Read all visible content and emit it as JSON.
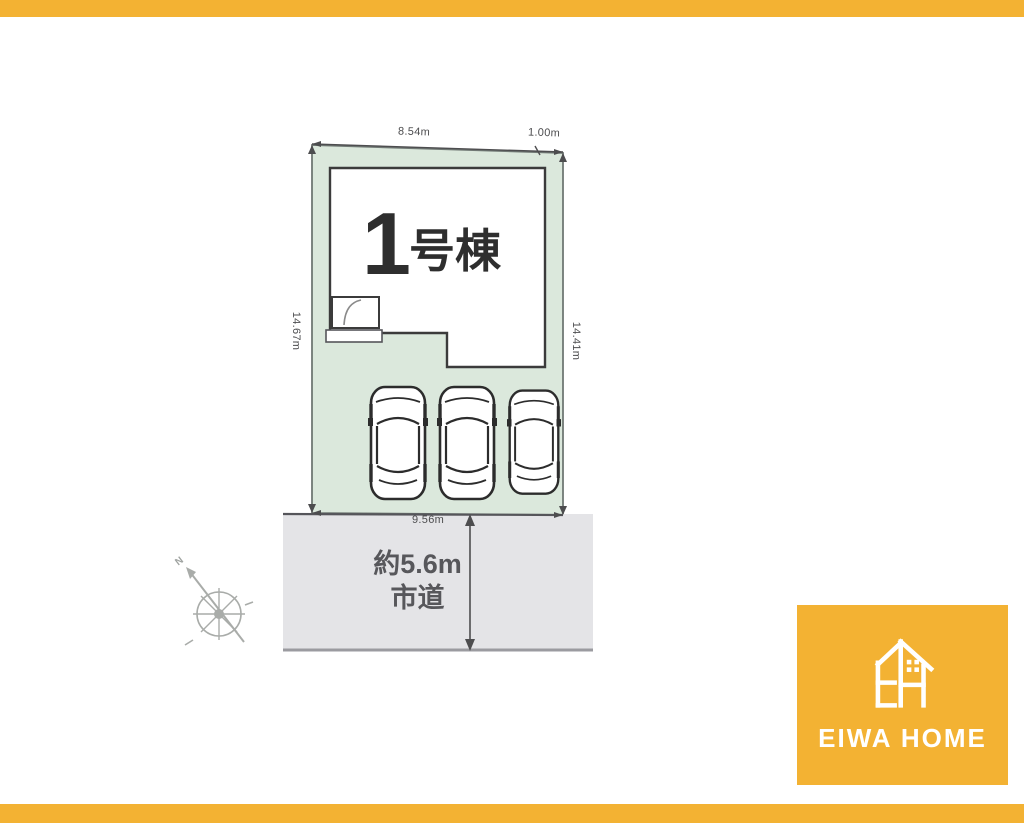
{
  "page": {
    "accent_orange": "#F3B233",
    "background": "#ffffff"
  },
  "site_plan": {
    "building_label": {
      "number": "1",
      "suffix": "号棟"
    },
    "dimensions": {
      "top_main": "8.54m",
      "top_right": "1.00m",
      "left": "14.67m",
      "right": "14.41m",
      "bottom": "9.56m"
    },
    "road": {
      "width_note": "約5.6m",
      "type": "市道"
    },
    "compass": {
      "north_label": "N"
    },
    "cars_count": 3,
    "colors": {
      "lot_fill": "#dbe8dc",
      "road_fill": "#e4e4e7",
      "building_outline": "#3b3b3b",
      "dimension_line": "#4d4d4f"
    }
  },
  "logo": {
    "text": "EIWA HOME",
    "background": "#F3B233"
  }
}
